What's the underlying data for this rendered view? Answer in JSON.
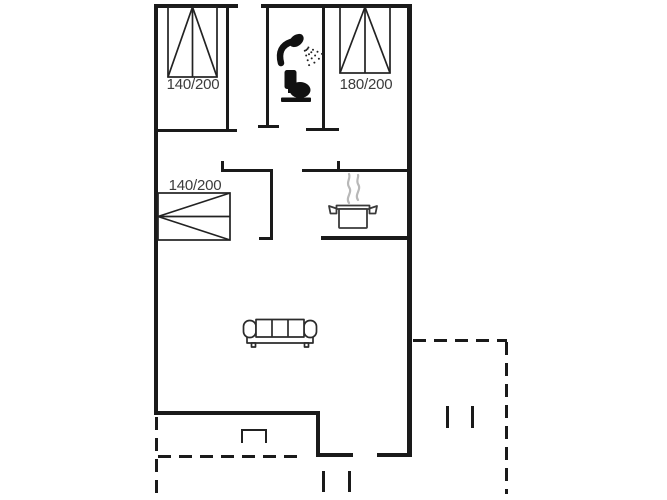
{
  "labels": {
    "bed_top_left": "140/200",
    "bed_top_right": "180/200",
    "bed_alcove": "140/200"
  },
  "colors": {
    "wall": "#1a1a1a",
    "background": "#ffffff",
    "label_text": "#3c3c3c",
    "steam": "#b8b8b8"
  },
  "icons": {
    "bed": "bed-icon",
    "shower": "shower-icon",
    "toilet": "toilet-icon",
    "stove_pot": "cooking-pot-icon",
    "sofa": "sofa-icon"
  }
}
